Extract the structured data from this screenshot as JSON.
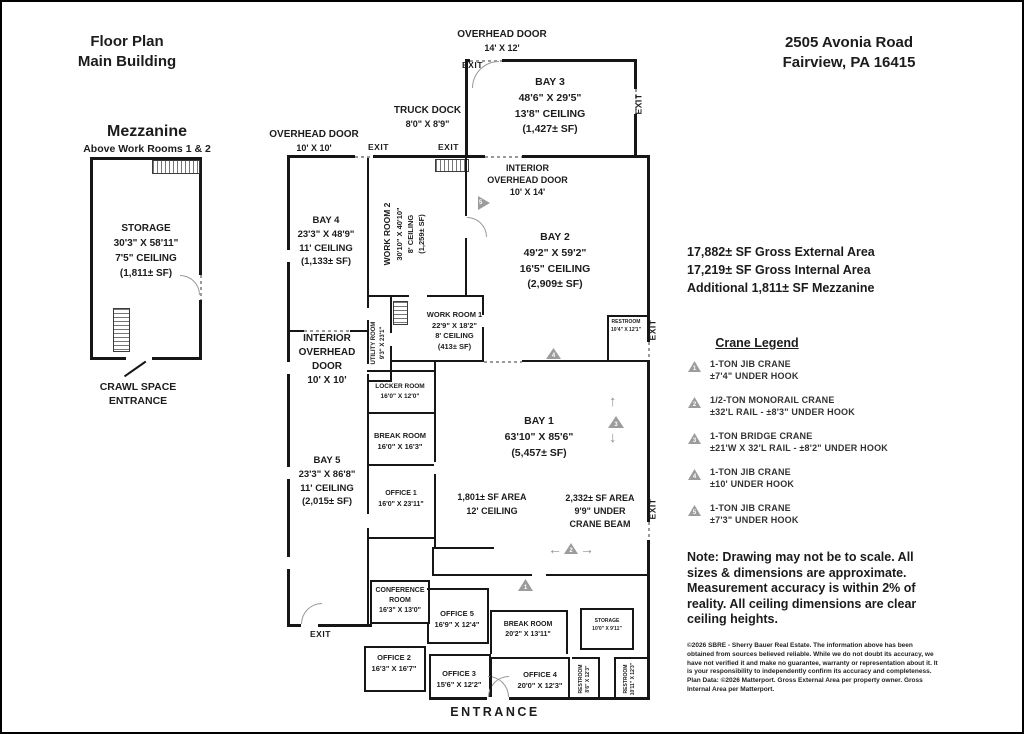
{
  "header": {
    "title_line1": "Floor Plan",
    "title_line2": "Main Building",
    "address_line1": "2505 Avonia Road",
    "address_line2": "Fairview, PA 16415"
  },
  "mezzanine": {
    "title": "Mezzanine",
    "subtitle": "Above Work Rooms 1 & 2",
    "storage": {
      "name": "STORAGE",
      "dims": "30'3\" X 58'11\"",
      "ceiling": "7'5\" CEILING",
      "area": "(1,811± SF)"
    },
    "crawl_line1": "CRAWL SPACE",
    "crawl_line2": "ENTRANCE"
  },
  "labels": {
    "exit": "EXIT",
    "entrance": "ENTRANCE"
  },
  "doors": {
    "ohd_top": {
      "line1": "OVERHEAD DOOR",
      "line2": "14' X 12'"
    },
    "truck_dock": {
      "line1": "TRUCK DOCK",
      "line2": "8'0\" X 8'9\""
    },
    "ohd_left": {
      "line1": "OVERHEAD DOOR",
      "line2": "10' X 10'"
    },
    "int_ohd_bay2": {
      "line1": "INTERIOR",
      "line2": "OVERHEAD DOOR",
      "line3": "10' X 14'"
    },
    "int_ohd_left": {
      "line1": "INTERIOR",
      "line2": "OVERHEAD",
      "line3": "DOOR",
      "line4": "10' X 10'"
    }
  },
  "rooms": {
    "bay3": {
      "name": "BAY 3",
      "dims": "48'6\" X 29'5\"",
      "ceiling": "13'8\" CEILING",
      "area": "(1,427± SF)"
    },
    "bay4": {
      "name": "BAY 4",
      "dims": "23'3\" X 48'9\"",
      "ceiling": "11' CEILING",
      "area": "(1,133± SF)"
    },
    "bay2": {
      "name": "BAY 2",
      "dims": "49'2\" X 59'2\"",
      "ceiling": "16'5\" CEILING",
      "area": "(2,909± SF)"
    },
    "bay1": {
      "name": "BAY 1",
      "dims": "63'10\" X 85'6\"",
      "area": "(5,457± SF)"
    },
    "bay5": {
      "name": "BAY 5",
      "dims": "23'3\" X 86'8\"",
      "ceiling": "11' CEILING",
      "area": "(2,015± SF)"
    },
    "workroom2": {
      "name": "WORK ROOM 2",
      "dims": "30'10\" X 40'10\"",
      "ceiling": "8' CEILING",
      "area": "(1,259± SF)"
    },
    "workroom1": {
      "name": "WORK ROOM 1",
      "dims": "22'9\" X 18'2\"",
      "ceiling": "8' CEILING",
      "area": "(413± SF)"
    },
    "utility": {
      "name": "UTILITY ROOM",
      "dims": "9'3\" X 23'1\""
    },
    "locker": {
      "name": "LOCKER ROOM",
      "dims": "16'0\" X 12'0\""
    },
    "break_mid": {
      "name": "BREAK ROOM",
      "dims": "16'0\" X 16'3\""
    },
    "office1": {
      "name": "OFFICE 1",
      "dims": "16'0\" X 23'11\""
    },
    "area_1801": {
      "line1": "1,801± SF AREA",
      "line2": "12' CEILING"
    },
    "area_2332": {
      "line1": "2,332± SF AREA",
      "line2": "9'9\" UNDER",
      "line3": "CRANE BEAM"
    },
    "restroom_bay2": {
      "name": "RESTROOM",
      "dims": "10'4\" X 12'1\""
    },
    "conference": {
      "name": "CONFERENCE ROOM",
      "dims": "16'3\" X 13'0\""
    },
    "office5": {
      "name": "OFFICE 5",
      "dims": "16'9\" X 12'4\""
    },
    "office2": {
      "name": "OFFICE 2",
      "dims": "16'3\" X 16'7\""
    },
    "office3": {
      "name": "OFFICE 3",
      "dims": "15'6\" X 12'2\""
    },
    "break_bottom": {
      "name": "BREAK ROOM",
      "dims": "20'2\" X 13'11\""
    },
    "storage_bottom": {
      "name": "STORAGE",
      "dims": "10'0\" X 9'11\""
    },
    "office4": {
      "name": "OFFICE 4",
      "dims": "20'0\" X 12'3\""
    },
    "restroom_a": {
      "name": "RESTROOM",
      "dims": "8'6\" X 12'3\""
    },
    "restroom_b": {
      "name": "RESTROOM",
      "dims": "10'11\" X 12'3\""
    }
  },
  "summary": {
    "line1": "17,882± SF Gross External Area",
    "line2": "17,219± SF Gross Internal Area",
    "line3": "Additional 1,811± SF Mezzanine"
  },
  "crane_legend": {
    "title": "Crane Legend",
    "items": [
      {
        "num": "1",
        "line1": "1-TON JIB CRANE",
        "line2": "±7'4\" UNDER HOOK"
      },
      {
        "num": "2",
        "line1": "1/2-TON MONORAIL CRANE",
        "line2": "±32'L RAIL - ±8'3\" UNDER HOOK"
      },
      {
        "num": "3",
        "line1": "1-TON BRIDGE CRANE",
        "line2": "±21'W X 32'L RAIL - ±8'2\" UNDER HOOK"
      },
      {
        "num": "4",
        "line1": "1-TON JIB CRANE",
        "line2": "±10' UNDER HOOK"
      },
      {
        "num": "5",
        "line1": "1-TON JIB CRANE",
        "line2": "±7'3\" UNDER HOOK"
      }
    ]
  },
  "markers": {
    "m1": "1",
    "m2": "2",
    "m3": "3",
    "m4": "4",
    "m5": "5"
  },
  "note": "Note: Drawing may not be to scale. All sizes & dimensions are approximate. Measurement accuracy is within 2% of reality. All ceiling dimensions are clear ceiling heights.",
  "copyright": "©2026 SBRE - Sherry Bauer Real Estate. The information above has been obtained from sources believed reliable. While we do not doubt its accuracy, we have not verified it and make no guarantee, warranty or representation about it. It is your responsibility to independently confirm its accuracy and completeness. Plan Data: ©2026 Matterport. Gross External Area per property owner. Gross Internal Area per Matterport."
}
